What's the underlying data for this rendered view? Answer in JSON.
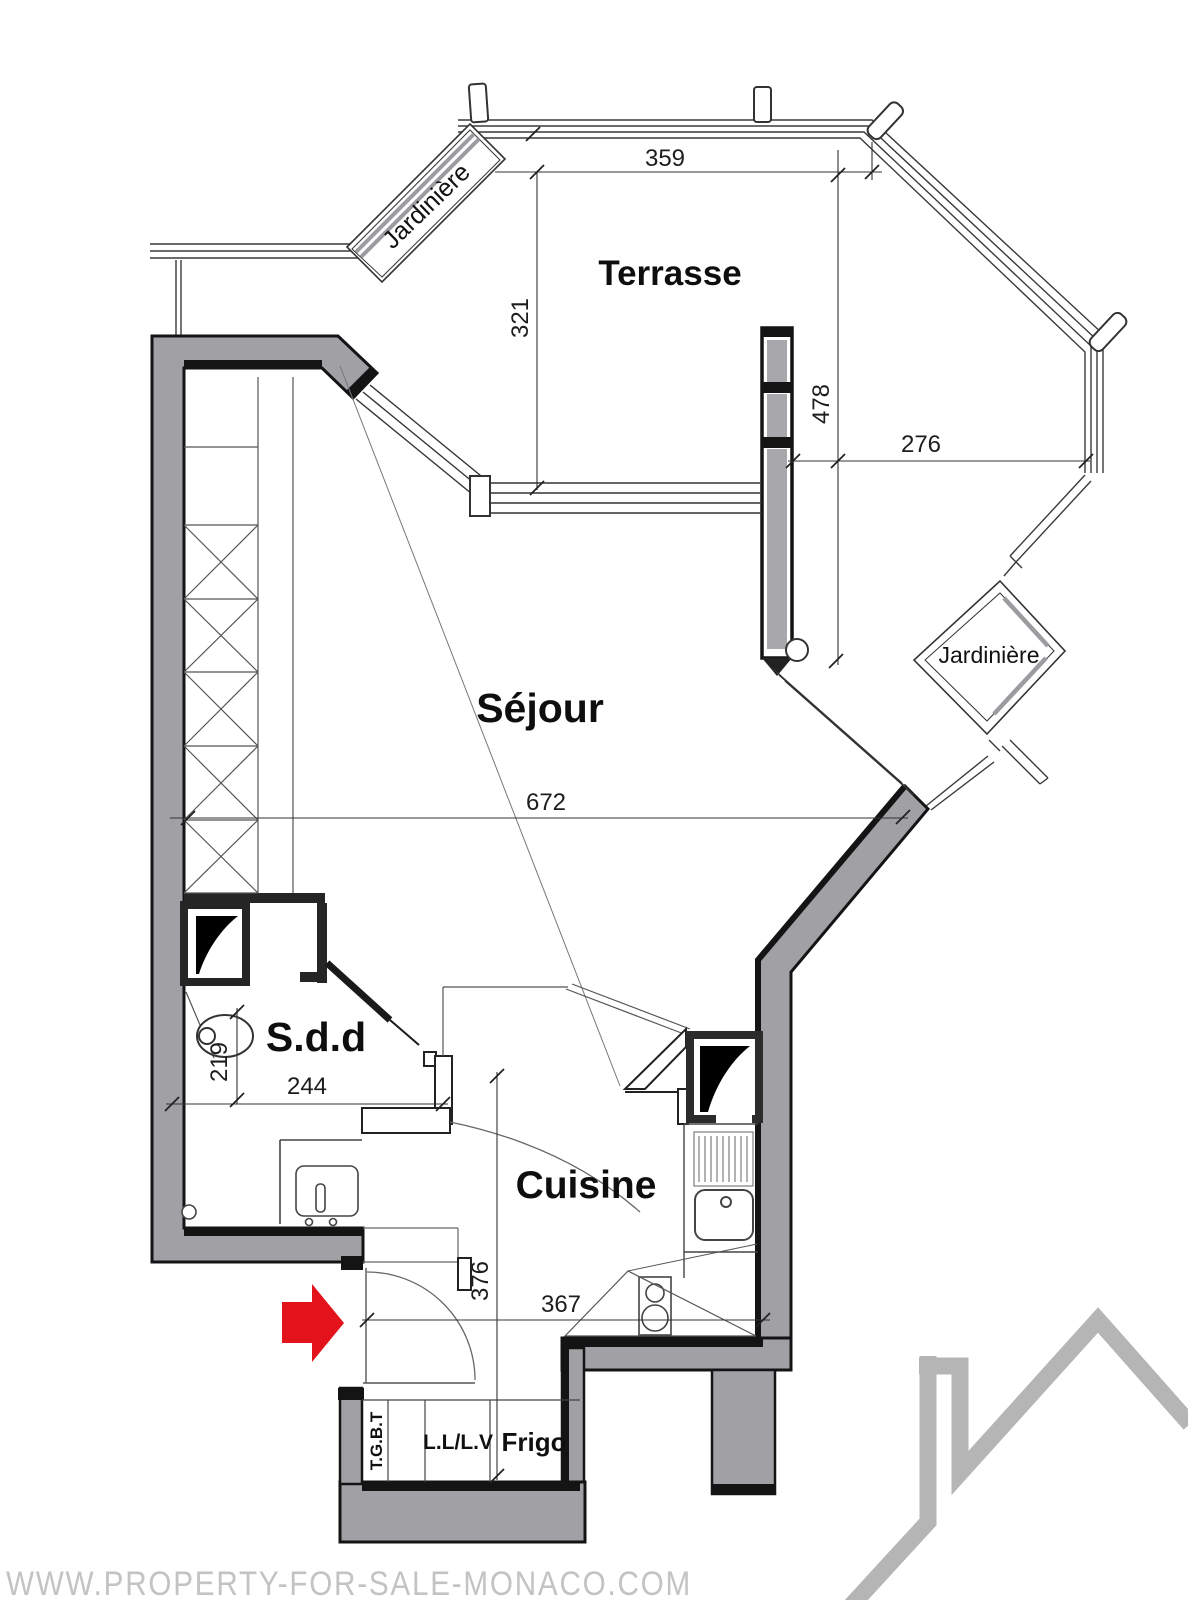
{
  "document": {
    "type": "apartment floor plan scan",
    "watermark": "WWW.PROPERTY-FOR-SALE-MONACO.COM"
  },
  "rooms": {
    "terrace": "Terrasse",
    "living": "Séjour",
    "bathroom": "S.d.d",
    "kitchen": "Cuisine"
  },
  "features": {
    "planter_top_left": "Jardinière",
    "planter_right": "Jardinière",
    "electrical_panel": "T.G.B.T",
    "washer_dishwasher": "L.L/L.V",
    "fridge": "Frigo"
  },
  "dimensions": {
    "terrace_width": "359",
    "terrace_depth": "321",
    "divider_wall_length": "478",
    "terrace_right_width": "276",
    "living_width": "672",
    "bathroom_depth": "219",
    "bathroom_width": "244",
    "hall_depth": "376",
    "kitchen_width": "367"
  },
  "icons": {
    "entrance_arrow": "red-entrance-arrow",
    "house_logo": "gray-house-outline"
  },
  "colors": {
    "wall_fill": "#a1a1a5",
    "wall_edge": "#141414",
    "thin_line": "#444444",
    "glass_gray": "#9c9ca0",
    "accent_red": "#e3131b",
    "watermark_gray": "#c3c3c3",
    "logo_gray": "#b5b5b5"
  }
}
